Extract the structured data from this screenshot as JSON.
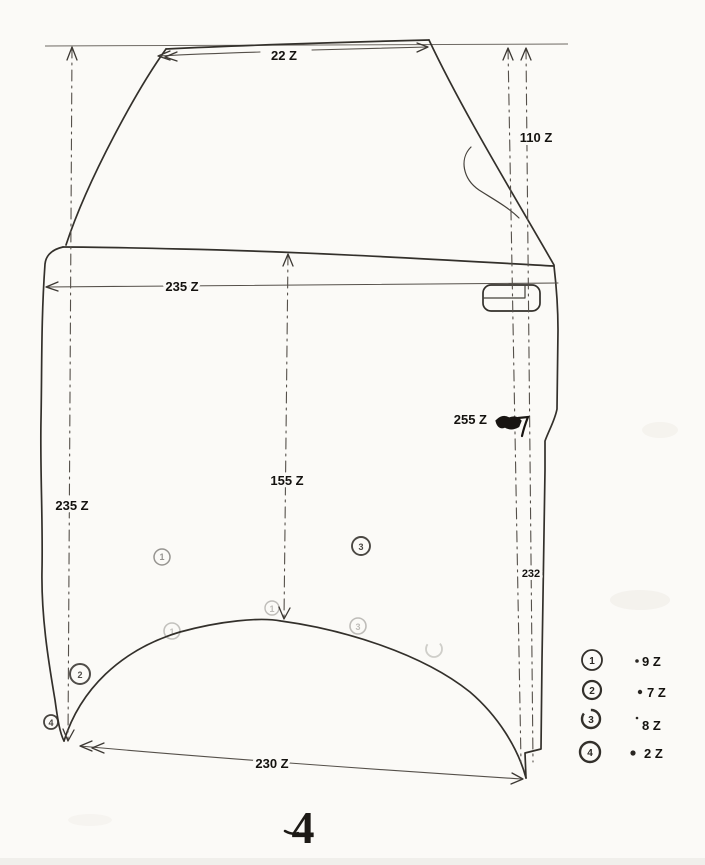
{
  "figure": {
    "number": "4"
  },
  "dimensions": {
    "top_width": "22 Z",
    "window_height": "110 Z",
    "body_width": "235 Z",
    "left_height": "235 Z",
    "center_height": "155 Z",
    "handle_offset": "255 Z",
    "right_height": "232",
    "bottom_width": "230 Z"
  },
  "callouts": {
    "point1": "1",
    "point2": "2",
    "point3": "3",
    "point4": "4",
    "faint_apex": "1",
    "faint_arc_left": "1",
    "faint_arc_right": "3"
  },
  "legend": {
    "items": [
      {
        "marker": "1",
        "value": "9 Z"
      },
      {
        "marker": "2",
        "value": "7 Z"
      },
      {
        "marker": "3",
        "value": "8 Z"
      },
      {
        "marker": "4",
        "value": "2 Z"
      }
    ]
  },
  "colors": {
    "paper": "#fbfaf7",
    "ink": "#33302b",
    "dim_line": "#55504a",
    "label_text": "#14120f"
  }
}
